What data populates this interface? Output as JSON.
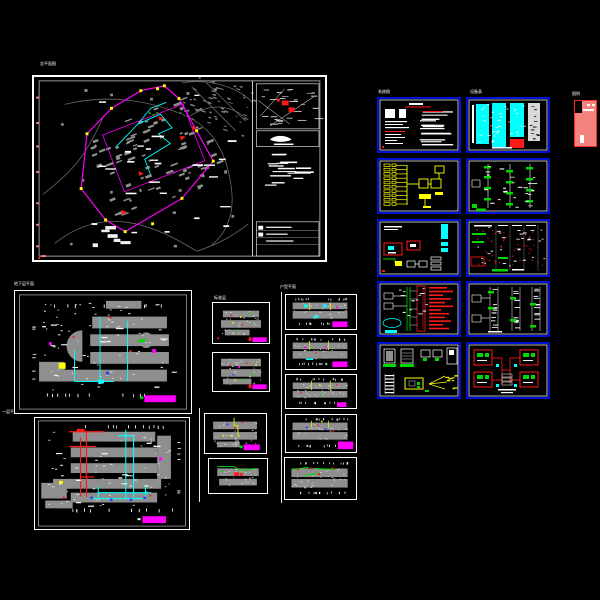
{
  "workspace": {
    "type": "cad-model-space",
    "background": "#000000",
    "description": "AutoCAD model space showing a residential electrical design set: site plan, floor plans, unit plans, system diagrams and detail sheets"
  },
  "palette": {
    "sheet_border": "#ffffff",
    "detail_sheet_border": "#0012d8",
    "linework_gray": "#8f8f8f",
    "road_gray": "#6a6a6a",
    "boundary_magenta": "#ff00ff",
    "wiring_cyan": "#00ffff",
    "highlight_yellow": "#ffff00",
    "alarm_red": "#ff1a1a",
    "signal_green": "#00d900",
    "accent_blue": "#2a3aff",
    "title_stamp": "#ff00ff",
    "legend_fill": "#f4837d",
    "legend_border": "#ff2a2a"
  },
  "labels": {
    "site": "总平面图",
    "fp2": "地下层平面",
    "fp3": "一层平面",
    "s4col": "标准层",
    "s8col": "户型平面",
    "gridc1": "系统图",
    "gridc2": "设备表",
    "legend": "图例"
  },
  "sheets": [
    {
      "id": "site-plan",
      "kind": "site plan with key map and notes panel",
      "stamp": false
    },
    {
      "id": "basement-plan",
      "kind": "large floor plan, cyan risers",
      "stamp": true
    },
    {
      "id": "first-floor-plan",
      "kind": "large floor plan, red/cyan riser trees",
      "stamp": true
    },
    {
      "id": "small-plan-1",
      "kind": "small floor plan, colored devices",
      "stamp": true
    },
    {
      "id": "small-plan-2",
      "kind": "small floor plan, colored devices",
      "stamp": true
    },
    {
      "id": "small-plan-3",
      "kind": "small floor plan, yellow-green run",
      "stamp": true
    },
    {
      "id": "small-plan-4",
      "kind": "small floor plan, green run",
      "stamp": false
    },
    {
      "id": "unit-plan-1",
      "kind": "unit plan, cyan/yellow",
      "stamp": true
    },
    {
      "id": "unit-plan-2",
      "kind": "unit plan, yellow-green risers",
      "stamp": true
    },
    {
      "id": "unit-plan-3",
      "kind": "unit plan, yellow-green risers",
      "stamp": true
    },
    {
      "id": "unit-plan-4",
      "kind": "unit plan, blue devices",
      "stamp": true
    },
    {
      "id": "unit-plan-5",
      "kind": "unit plan, green runs",
      "stamp": false
    },
    {
      "id": "grid-r1c1",
      "kind": "specification notes text sheet",
      "stamp": false
    },
    {
      "id": "grid-r1c2",
      "kind": "table with cyan columns and red block",
      "stamp": false
    },
    {
      "id": "grid-r2c1",
      "kind": "yellow distribution system schematic",
      "stamp": false
    },
    {
      "id": "grid-r2c2",
      "kind": "riser diagram with green taps",
      "stamp": false
    },
    {
      "id": "grid-r3c1",
      "kind": "detail with red boxes and cyan blocks",
      "stamp": false
    },
    {
      "id": "grid-r3c2",
      "kind": "points table with red dots and green bars",
      "stamp": false
    },
    {
      "id": "grid-r4c1",
      "kind": "fire-alarm riser, red annotations, cyan cloud",
      "stamp": false
    },
    {
      "id": "grid-r4c2",
      "kind": "white riser diagram with green taps",
      "stamp": false
    },
    {
      "id": "grid-r5c1",
      "kind": "equipment installation details",
      "stamp": false
    },
    {
      "id": "grid-r5c2",
      "kind": "symmetric unit distribution diagram, red boxes",
      "stamp": false
    }
  ],
  "legend": {
    "fill": "#f4837d",
    "border": "#ff2a2a"
  }
}
